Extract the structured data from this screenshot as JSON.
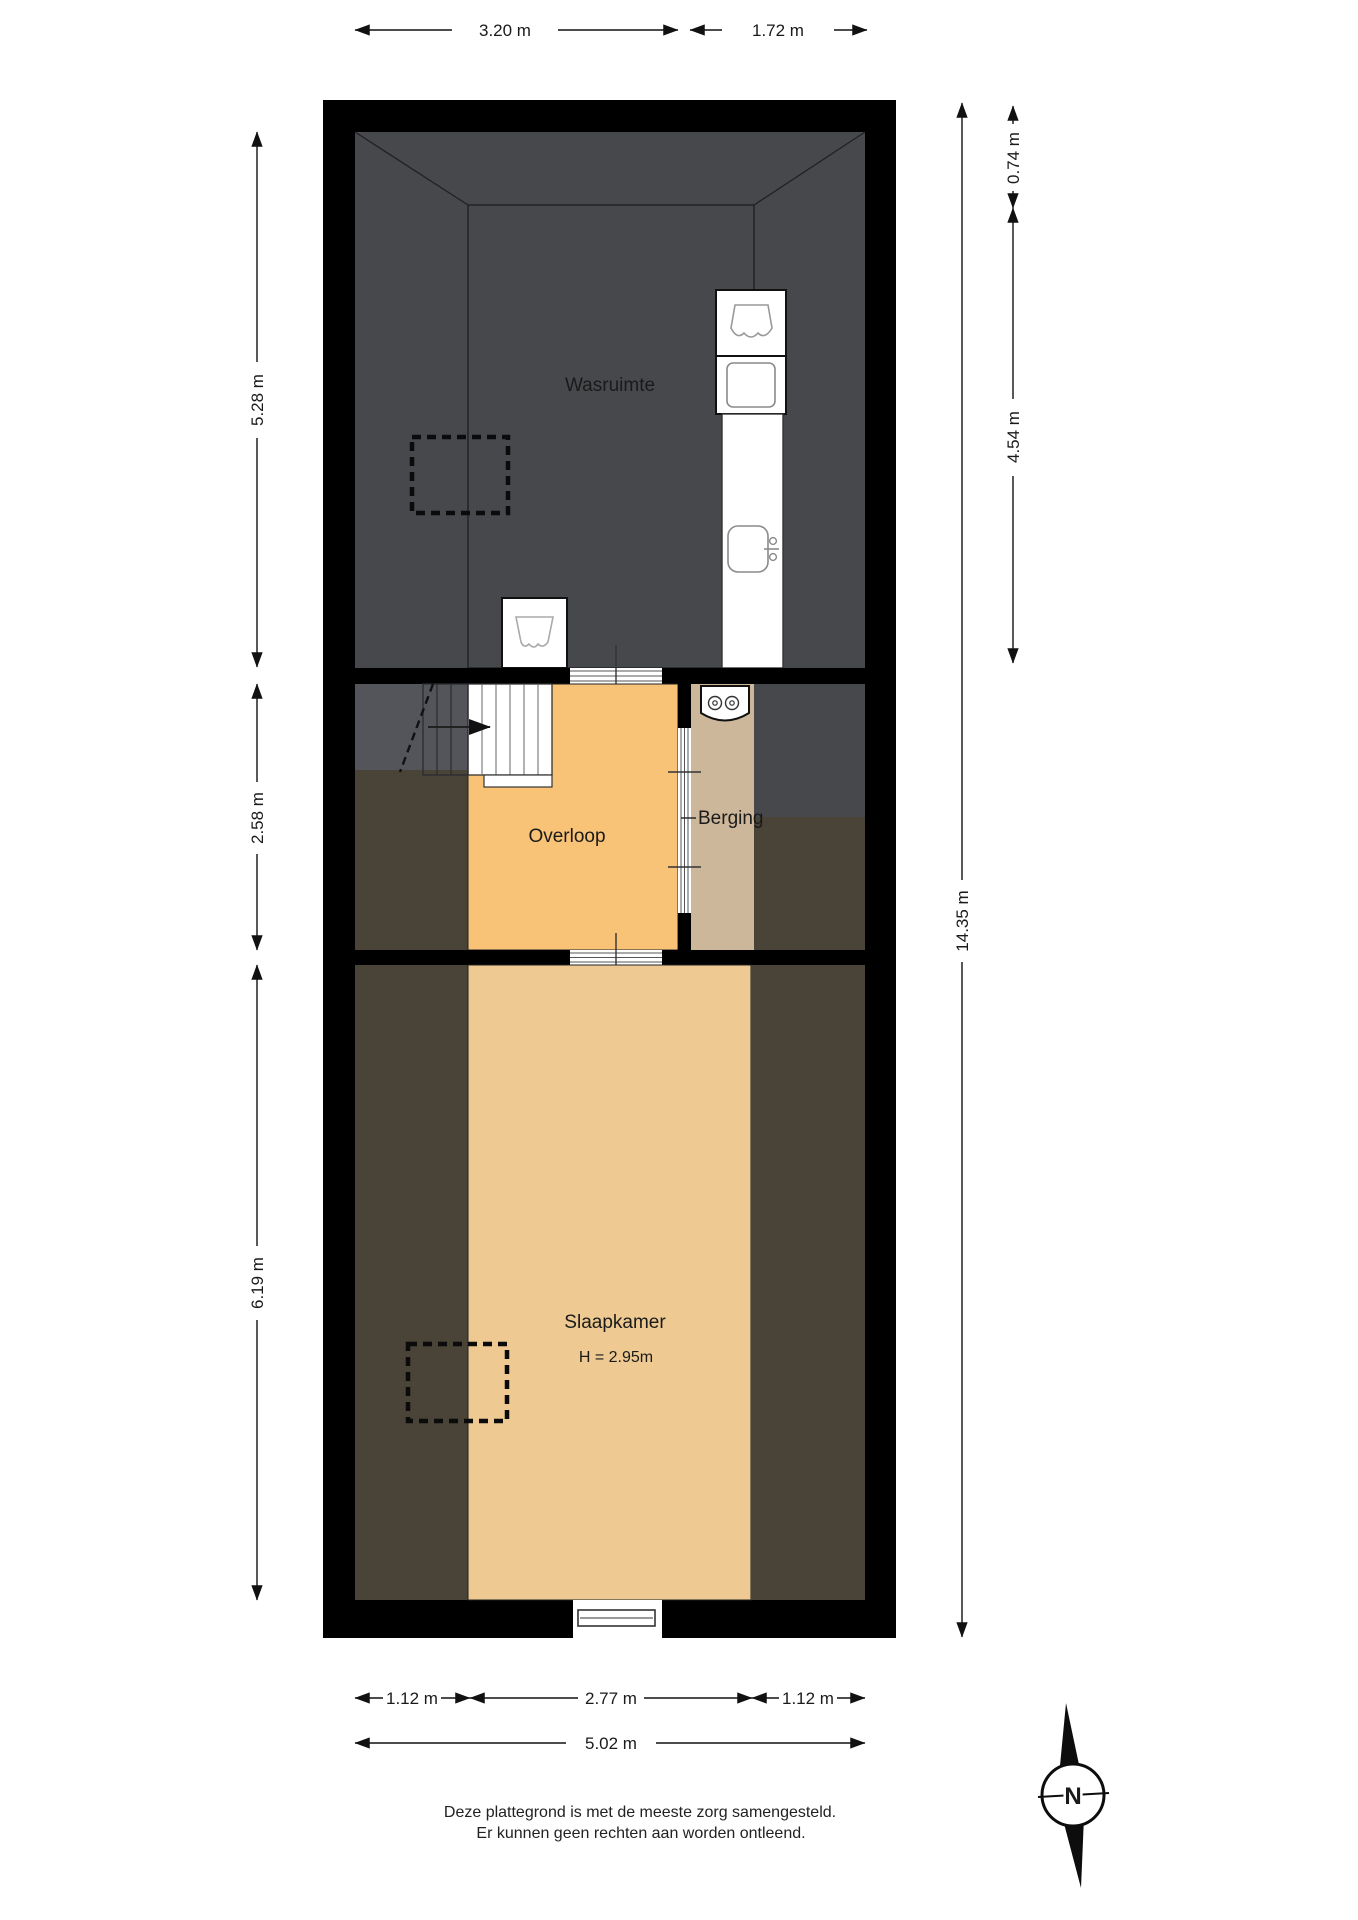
{
  "plan": {
    "rooms": {
      "wasruimte": {
        "label": "Wasruimte"
      },
      "overloop": {
        "label": "Overloop"
      },
      "berging": {
        "label": "Berging"
      },
      "slaapkamer": {
        "label": "Slaapkamer",
        "height_label": "H = 2.95m"
      }
    },
    "dimensions": {
      "top": [
        {
          "label": "3.20 m"
        },
        {
          "label": "1.72 m"
        }
      ],
      "left": [
        {
          "label": "5.28 m"
        },
        {
          "label": "2.58 m"
        },
        {
          "label": "6.19 m"
        }
      ],
      "right": [
        {
          "label": "0.74 m"
        },
        {
          "label": "4.54 m"
        },
        {
          "label": "14.35 m"
        }
      ],
      "bottom": [
        {
          "label": "1.12 m"
        },
        {
          "label": "2.77 m"
        },
        {
          "label": "1.12 m"
        }
      ],
      "total_width": {
        "label": "5.02 m"
      }
    },
    "compass": {
      "label": "N"
    },
    "footer": {
      "line1": "Deze plattegrond is met de meeste zorg samengesteld.",
      "line2": "Er kunnen geen rechten aan worden ontleend."
    }
  },
  "colors": {
    "wall_black": "#000000",
    "attic_gray": "#46484c",
    "attic_gray_light": "#54555a",
    "dead_brown": "#4a4337",
    "wasruimte_floor": "#d9e3f0",
    "overloop_floor": "#f9c377",
    "berging_floor": "#cdb79b",
    "slaapkamer_floor": "#eeca92",
    "fixture_white": "#ffffff"
  }
}
